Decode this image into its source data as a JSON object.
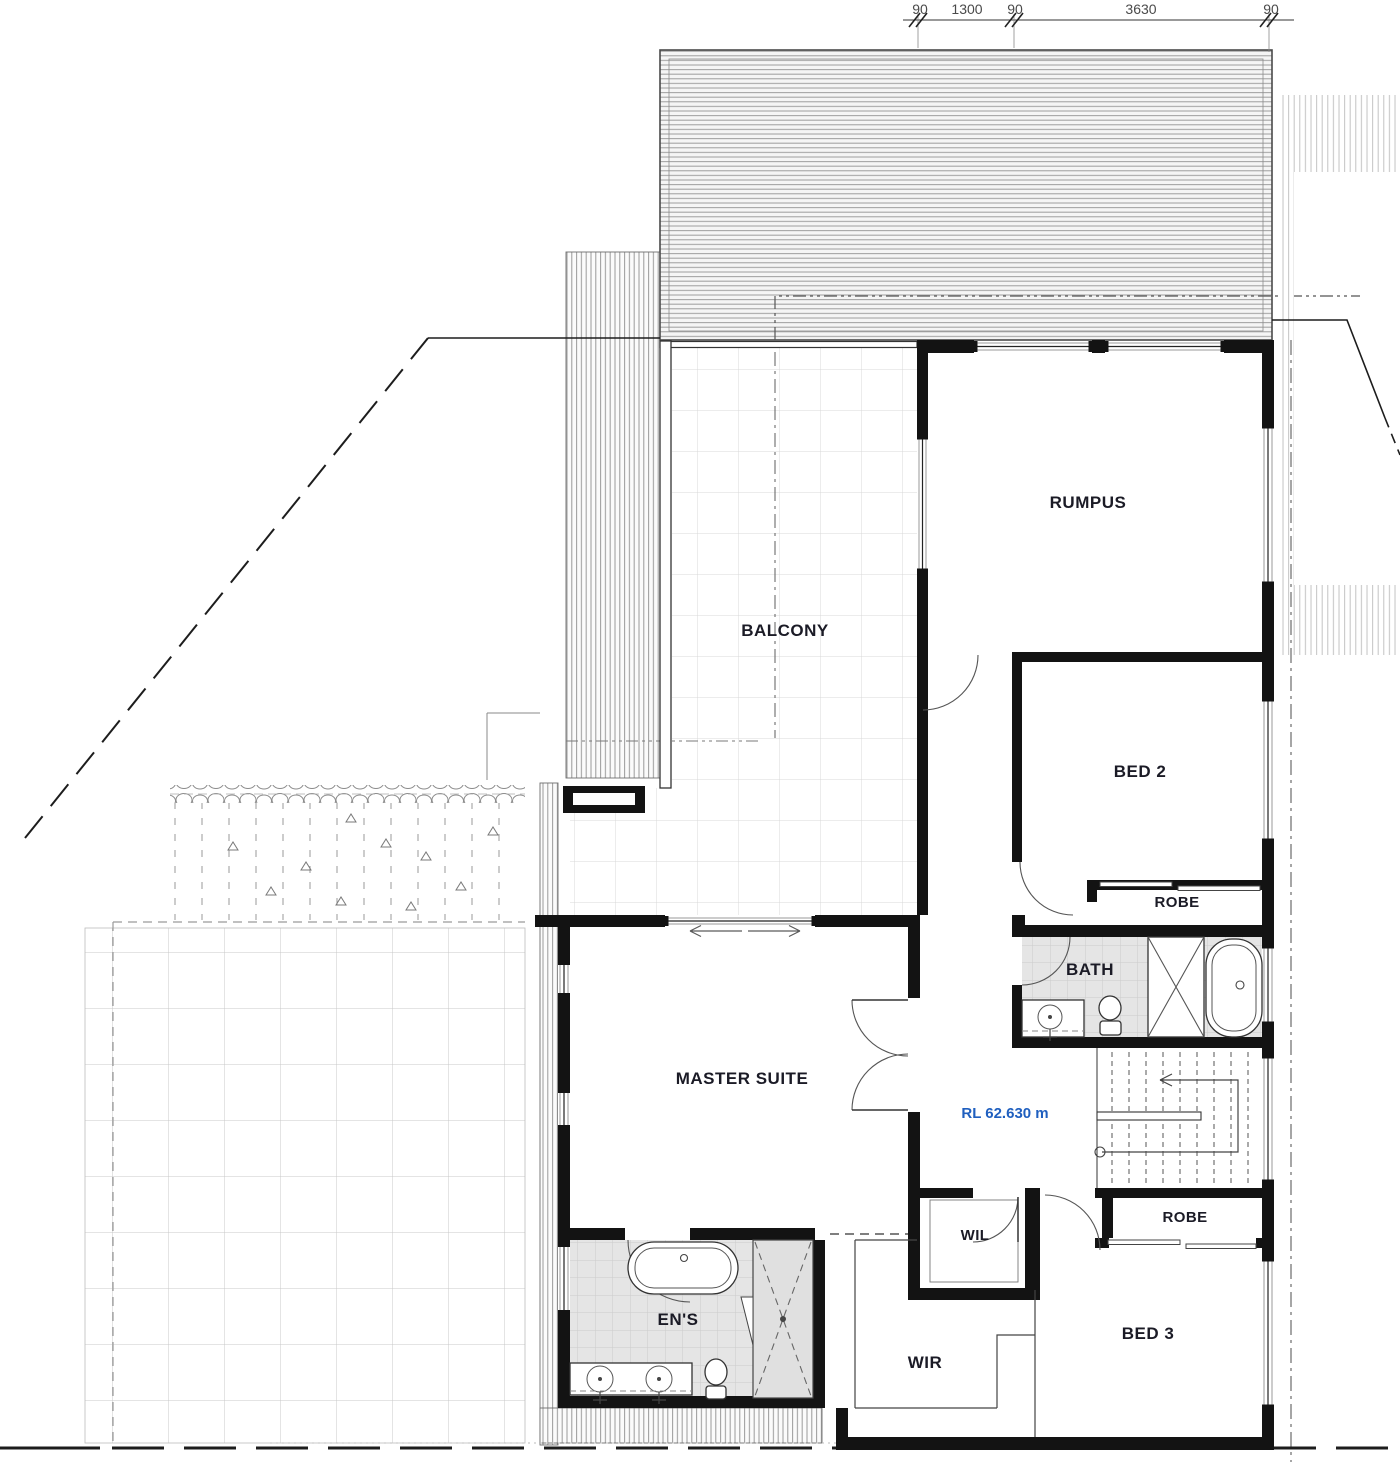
{
  "dimensions": {
    "labels": [
      "90",
      "1300",
      "90",
      "3630",
      "90"
    ]
  },
  "rooms": {
    "balcony": "BALCONY",
    "rumpus": "RUMPUS",
    "bed2": "BED 2",
    "robe_upper": "ROBE",
    "bath": "BATH",
    "master": "MASTER SUITE",
    "wil": "WIL",
    "robe_lower": "ROBE",
    "ens": "EN'S",
    "wir": "WIR",
    "bed3": "BED 3"
  },
  "annotations": {
    "rl_level": "RL 62.630 m"
  },
  "colors": {
    "wall": "#131313",
    "label_text": "#1b1b26",
    "rl_text": "#1f5fbf",
    "tile_fill": "#e6e6e6",
    "dim_text": "#4a4a4a"
  }
}
